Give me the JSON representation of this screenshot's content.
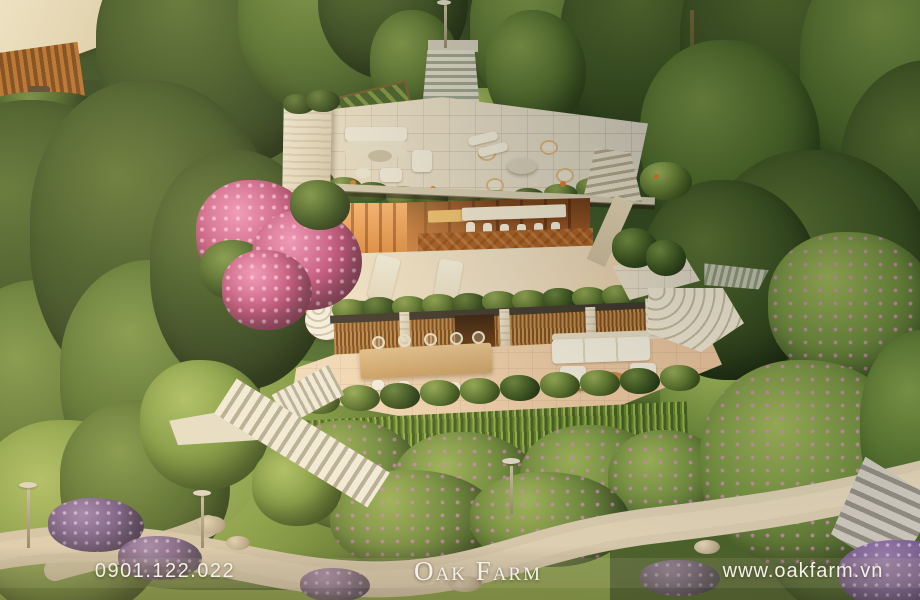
{
  "footer": {
    "phone": "0901.122.022",
    "brand": "Oak Farm",
    "website": "www.oakfarm.vn"
  },
  "palette": {
    "forest_dark": "#243517",
    "forest_mid": "#54702f",
    "grass_bright": "#9db54e",
    "stone_pavers": "#e8e2d3",
    "stone_wall": "#e9dfc8",
    "wood_warm": "#b2672c",
    "interior_glow": "#ffb870",
    "bougainvillea_pink": "#c2527f",
    "lavender_purple": "#7a5f92",
    "path_stone": "#d3c6ab",
    "footer_text": "#f4f1e9"
  }
}
